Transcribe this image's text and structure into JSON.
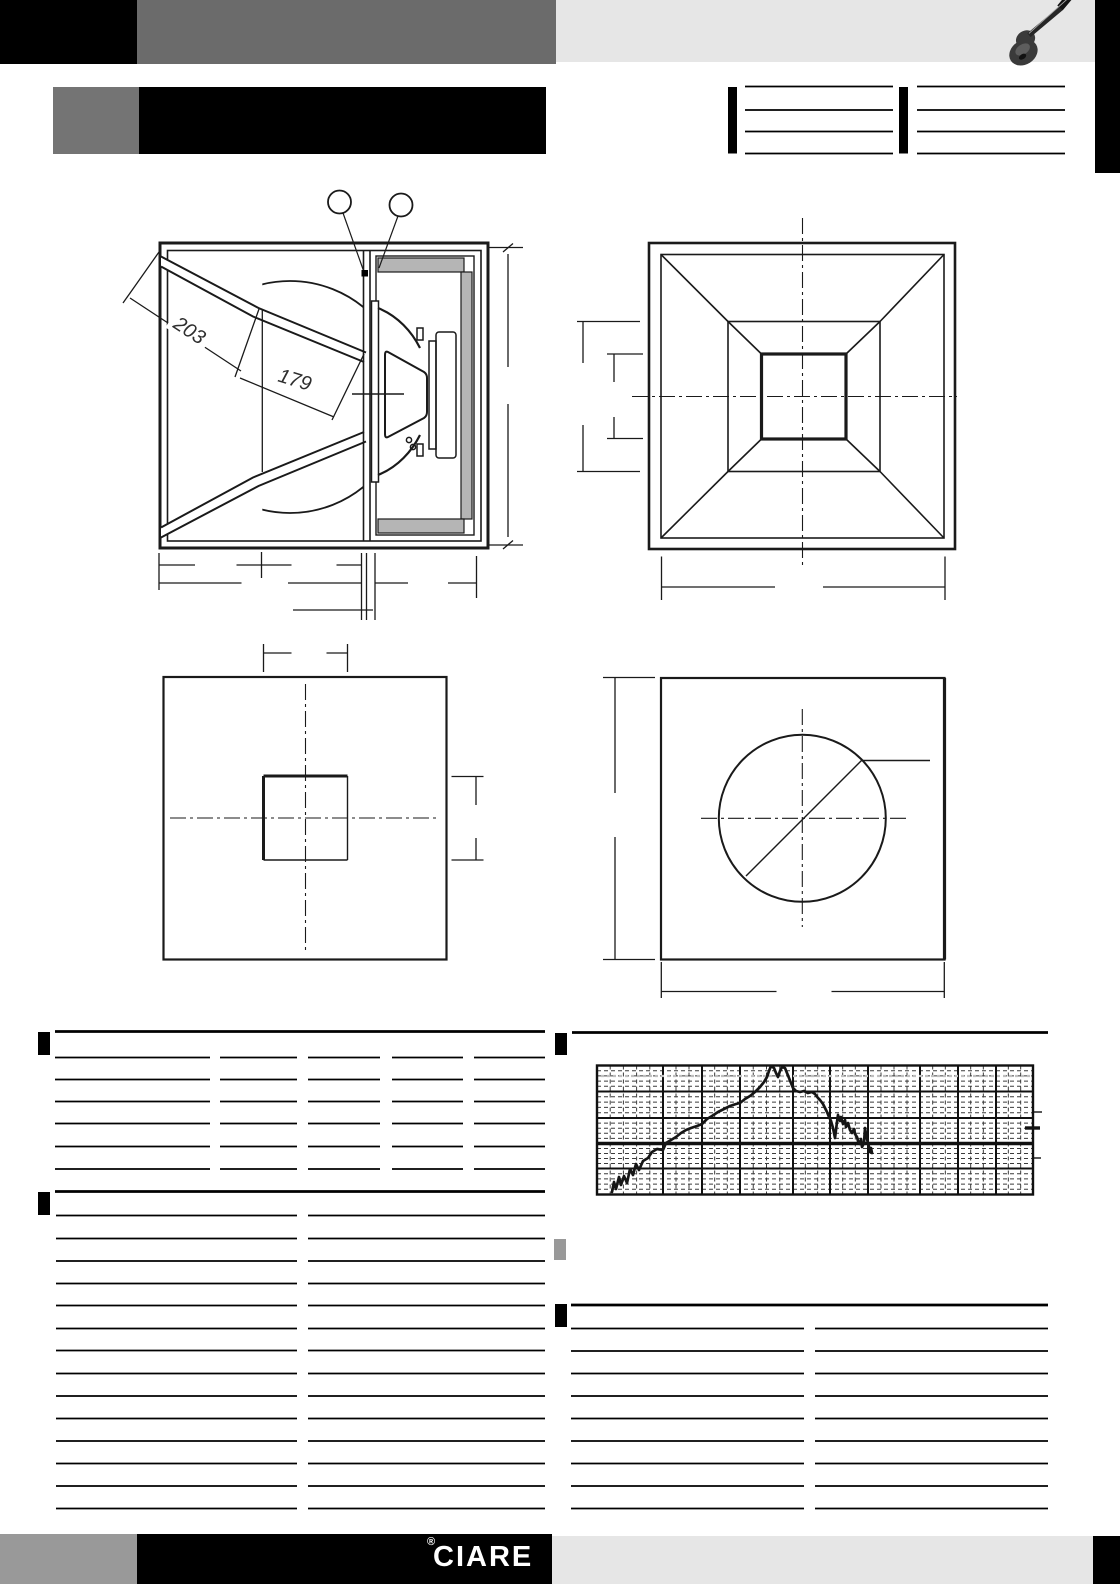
{
  "page": {
    "width": 1120,
    "height": 1584,
    "background": "#ffffff"
  },
  "header": {
    "black_bar_color": "#000000",
    "gray_bar_color": "#6b6b6b",
    "light_band_color": "#e6e6e6",
    "right_strip_color": "#000000",
    "guitar_icon": "guitar-icon"
  },
  "title_block": {
    "accent_square_color": "#747474",
    "title_bar_color": "#000000",
    "title_text": ""
  },
  "reference_tables": {
    "left_table_blank_rows": 3,
    "right_table_blank_rows": 3
  },
  "drawings": {
    "cross_section": {
      "dim_upper_brace": "203",
      "dim_lower_brace": "179",
      "callout_count": 2,
      "damping_panel_fill": "#b5b5b5"
    },
    "front_horn_view": {
      "nested_squares": 4
    },
    "rear_panel_view": {
      "cutout": "square"
    },
    "front_panel_view": {
      "cutout": "circle"
    }
  },
  "section_markers": [
    {
      "color": "#000000"
    },
    {
      "color": "#000000"
    },
    {
      "color": "#000000"
    },
    {
      "color": "#000000"
    },
    {
      "color": "#999999"
    }
  ],
  "spec_tables": {
    "top_left_blank_rows": 6,
    "bottom_left_blank_rows": 14,
    "bottom_right_blank_rows": 9
  },
  "chart_data": {
    "type": "line",
    "title": "",
    "series": [
      {
        "name": "frequency-response"
      }
    ],
    "x_axis": {
      "scale": "log",
      "unit": "Hz",
      "majors_hz": [
        50,
        100,
        200,
        500,
        1000,
        2000,
        5000,
        10000,
        20000
      ],
      "range_hz": [
        15,
        40000
      ],
      "tick_labels_printed": false
    },
    "y_axis": {
      "unit": "dB",
      "major_divisions": 5,
      "tick_labels_printed": false
    },
    "grid": {
      "major": "solid",
      "minor": "dashed"
    },
    "plot_box_px": {
      "left": 597,
      "top": 1065.5,
      "right": 1033,
      "bottom": 1194.5
    },
    "x_majors_px": [
      663,
      702,
      740,
      793,
      830,
      868,
      920,
      958,
      996
    ],
    "y_majors_px": [
      1091.5,
      1118,
      1143.5,
      1168.5
    ],
    "emphasis_y_px": 1143.5,
    "reference_line_px": {
      "y": 1076,
      "color": "#bfbfbf"
    },
    "right_ticks_px": [
      {
        "y": 1112,
        "x1": 1033,
        "x2": 1042,
        "w": 1.4
      },
      {
        "y": 1128,
        "x1": 1025,
        "x2": 1040,
        "w": 3.4
      },
      {
        "y": 1158,
        "x1": 1033,
        "x2": 1041,
        "w": 1.4
      }
    ],
    "curve_px": [
      [
        612,
        1192
      ],
      [
        614,
        1182
      ],
      [
        616,
        1189
      ],
      [
        619,
        1177
      ],
      [
        621,
        1185
      ],
      [
        624,
        1176
      ],
      [
        627,
        1183
      ],
      [
        630,
        1169
      ],
      [
        633,
        1175
      ],
      [
        636,
        1164
      ],
      [
        639,
        1170
      ],
      [
        643,
        1161
      ],
      [
        648,
        1158
      ],
      [
        652,
        1152
      ],
      [
        657,
        1149
      ],
      [
        663,
        1150
      ],
      [
        666,
        1143
      ],
      [
        671,
        1140
      ],
      [
        676,
        1137
      ],
      [
        681,
        1133
      ],
      [
        686,
        1130
      ],
      [
        691,
        1128
      ],
      [
        697,
        1126
      ],
      [
        702,
        1124
      ],
      [
        707,
        1119
      ],
      [
        712,
        1116
      ],
      [
        718,
        1112
      ],
      [
        724,
        1109
      ],
      [
        730,
        1106
      ],
      [
        736,
        1104
      ],
      [
        740,
        1103
      ],
      [
        745,
        1099
      ],
      [
        750,
        1096
      ],
      [
        755,
        1092
      ],
      [
        760,
        1087
      ],
      [
        764,
        1082
      ],
      [
        767,
        1077
      ],
      [
        769,
        1071
      ],
      [
        771,
        1066
      ],
      [
        774,
        1068
      ],
      [
        776,
        1073
      ],
      [
        778,
        1077
      ],
      [
        780,
        1071
      ],
      [
        782,
        1067
      ],
      [
        785,
        1068
      ],
      [
        787,
        1073
      ],
      [
        789,
        1078
      ],
      [
        791,
        1083
      ],
      [
        793,
        1088
      ],
      [
        796,
        1091
      ],
      [
        800,
        1092
      ],
      [
        804,
        1091
      ],
      [
        808,
        1093
      ],
      [
        812,
        1092
      ],
      [
        815,
        1094
      ],
      [
        818,
        1098
      ],
      [
        820,
        1100
      ],
      [
        823,
        1104
      ],
      [
        825,
        1108
      ],
      [
        827,
        1112
      ],
      [
        829,
        1117
      ],
      [
        831,
        1121
      ],
      [
        833,
        1128
      ],
      [
        835,
        1138
      ],
      [
        836,
        1130
      ],
      [
        837,
        1122
      ],
      [
        838,
        1115
      ],
      [
        840,
        1121
      ],
      [
        841,
        1117
      ],
      [
        843,
        1124
      ],
      [
        845,
        1120
      ],
      [
        846,
        1127
      ],
      [
        848,
        1123
      ],
      [
        850,
        1130
      ],
      [
        852,
        1133
      ],
      [
        854,
        1129
      ],
      [
        855,
        1134
      ],
      [
        857,
        1137
      ],
      [
        858,
        1141
      ],
      [
        860,
        1144
      ],
      [
        861,
        1139
      ],
      [
        862,
        1147
      ],
      [
        864,
        1143
      ],
      [
        865,
        1128
      ],
      [
        866,
        1134
      ],
      [
        867,
        1139
      ],
      [
        869,
        1147
      ],
      [
        870,
        1152
      ],
      [
        871,
        1148
      ],
      [
        872,
        1153
      ]
    ],
    "description": "Unlabelled SPL curve: rises from low frequency, peaks near 500-600 Hz, short plateau, steep jagged roll-off with deep notch just above 1 kHz, trace ends near 2 kHz"
  },
  "footer": {
    "logo_text": "CIARE",
    "registered_mark": "®",
    "left_gray_color": "#999999",
    "black_bar_color": "#000000",
    "light_band_color": "#e6e6e6",
    "right_strip_color": "#000000"
  }
}
